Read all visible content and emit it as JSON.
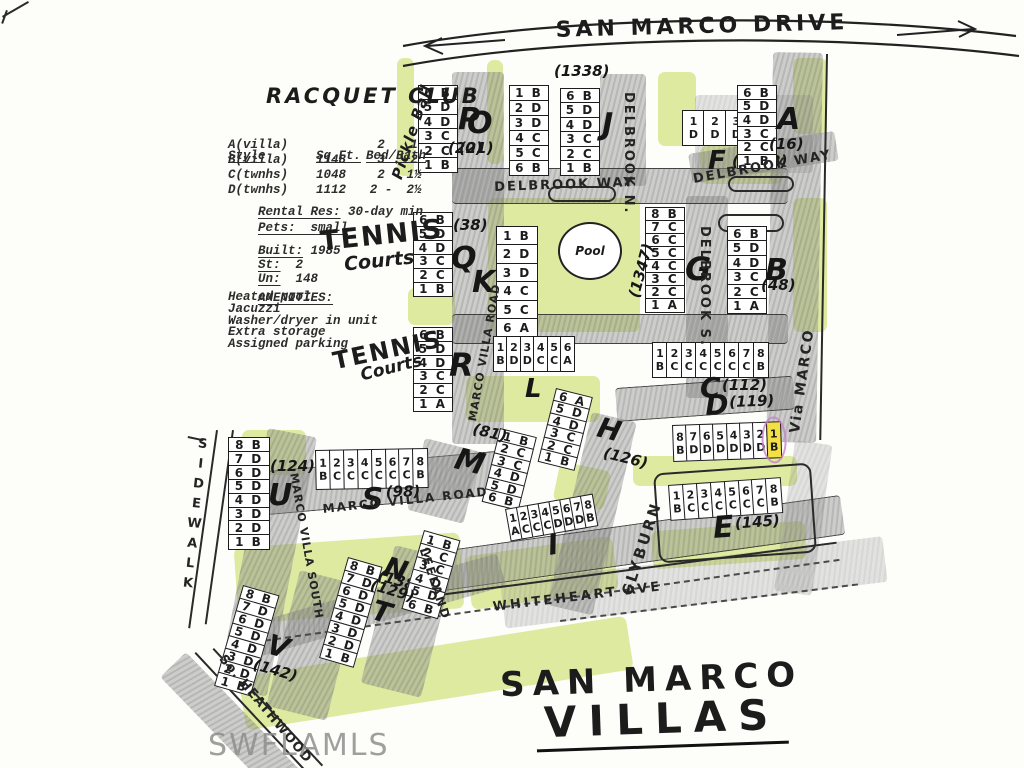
{
  "page": {
    "top_street": "SAN MARCO DRIVE",
    "bottom_title_line1": "SAN MARCO",
    "bottom_title_line2": "VILLAS",
    "watermark": "SWFLAMLS"
  },
  "legend": {
    "club_title": "RACQUET CLUB",
    "pickleball": "Pickle Ball",
    "table": {
      "col_style": "Style",
      "col_sqft": "Sq.Ft.",
      "col_bedbath": "Bed/Bath",
      "rows": [
        {
          "style": "A(villa)",
          "sqft": "",
          "bed": "2",
          "bath": "1"
        },
        {
          "style": "B(villa)",
          "sqft": "1148",
          "bed": "3",
          "bath": "2"
        },
        {
          "style": "C(twnhs)",
          "sqft": "1048",
          "bed": "2",
          "bath": "1½"
        },
        {
          "style": "D(twnhs)",
          "sqft": "1112",
          "bed": "2 -",
          "bath": "2½"
        }
      ]
    },
    "rental_label": "Rental Res:",
    "rental_value": " 30-day min",
    "pets_label": "Pets:",
    "pets_value": "  small",
    "built_label": "Built:",
    "built_value": " 1985",
    "st_label": "St:",
    "st_value": "  2",
    "un_label": "Un:",
    "un_value": "  148",
    "amenities_title": "AMENITIES:",
    "amenities": [
      "Heated pool",
      "Jacuzzi",
      "Washer/dryer in unit",
      "Extra storage",
      "Assigned parking"
    ]
  },
  "labels": {
    "tennis_1a": "TENNIS",
    "tennis_1b": "Courts",
    "tennis_2a": "TENNIS",
    "tennis_2b": "Courts",
    "pool": "Pool"
  },
  "streets": [
    {
      "id": "delbrook-way-w",
      "name": "DELBROOK  WAY"
    },
    {
      "id": "delbrook-way-e",
      "name": "DELBROOK  WAY"
    },
    {
      "id": "delbrook-n",
      "name": "DELBROOK  N."
    },
    {
      "id": "delbrook-s",
      "name": "DELBROOK  S."
    },
    {
      "id": "via-marco",
      "name": "Via  MARCO"
    },
    {
      "id": "marco-villa-road-n",
      "name": "MARCO  VILLA  ROAD"
    },
    {
      "id": "marco-villa-road-s",
      "name": "MARCO   VILLA   ROAD"
    },
    {
      "id": "marco-villa-south",
      "name": "MARCO  VILLA  SOUTH"
    },
    {
      "id": "clyburn",
      "name": "CLYBURN"
    },
    {
      "id": "leeland",
      "name": "LEELAND"
    },
    {
      "id": "whiteheart",
      "name": "WHITEHEART   AVE"
    },
    {
      "id": "so-heathwood",
      "name": "So. HEATHWOOD"
    },
    {
      "id": "sidewalk",
      "name": "SIDEWALK"
    }
  ],
  "buildings": [
    {
      "id": "P",
      "label": "P",
      "number": "(20)",
      "units": [
        "6B",
        "5D",
        "4D",
        "3C",
        "2C",
        "1B"
      ]
    },
    {
      "id": "O",
      "label": "O",
      "number": "(21)",
      "units": [
        "1B",
        "2D",
        "3D",
        "4C",
        "5C",
        "6B"
      ]
    },
    {
      "id": "J",
      "label": "J",
      "number": "(1338)",
      "units": [
        "6B",
        "5D",
        "4D",
        "3C",
        "2C",
        "1B"
      ]
    },
    {
      "id": "F",
      "label": "F",
      "number": "(1352)",
      "units": [
        "1D",
        "2D",
        "3D",
        "4A"
      ]
    },
    {
      "id": "A",
      "label": "A",
      "number": "(16)",
      "units": [
        "6B",
        "5D",
        "4D",
        "3C",
        "2C",
        "1B"
      ]
    },
    {
      "id": "Q",
      "label": "Q",
      "number": "(38)",
      "units": [
        "6B",
        "5D",
        "4D",
        "3C",
        "2C",
        "1B"
      ]
    },
    {
      "id": "K",
      "label": "K",
      "number": "",
      "units": [
        "1B",
        "2D",
        "3D",
        "4C",
        "5C",
        "6A"
      ]
    },
    {
      "id": "G",
      "label": "G",
      "number": "(1347)",
      "units": [
        "8B",
        "7C",
        "6C",
        "5C",
        "4C",
        "3C",
        "2C",
        "1A"
      ]
    },
    {
      "id": "B",
      "label": "B",
      "number": "(48)",
      "units": [
        "6B",
        "5D",
        "4D",
        "3C",
        "2C",
        "1A"
      ]
    },
    {
      "id": "R",
      "label": "R",
      "number": "",
      "units": [
        "6B",
        "5D",
        "4D",
        "3C",
        "2C",
        "1A"
      ]
    },
    {
      "id": "L",
      "label": "L",
      "number": "",
      "units": [
        "1B",
        "2D",
        "3D",
        "4C",
        "5C",
        "6A"
      ]
    },
    {
      "id": "C",
      "label": "C",
      "number": "(112)",
      "units": [
        "1B",
        "2C",
        "3C",
        "4C",
        "5C",
        "6C",
        "7C",
        "8B"
      ]
    },
    {
      "id": "D",
      "label": "D",
      "number": "(119)",
      "units": [
        "8B",
        "7D",
        "6D",
        "5D",
        "4D",
        "3D",
        "2D",
        "1B"
      ],
      "highlight_unit": "1B"
    },
    {
      "id": "H",
      "label": "H",
      "number": "(126)",
      "units": [
        "6A",
        "5D",
        "4D",
        "3C",
        "2C",
        "1B"
      ]
    },
    {
      "id": "M",
      "label": "M",
      "number": "(81)",
      "units": [
        "1B",
        "2C",
        "3C",
        "4D",
        "5D",
        "6B"
      ]
    },
    {
      "id": "E",
      "label": "E",
      "number": "(145)",
      "units": [
        "1B",
        "2C",
        "3C",
        "4C",
        "5C",
        "6C",
        "7C",
        "8B"
      ]
    },
    {
      "id": "I",
      "label": "I",
      "number": "",
      "units": [
        "1A",
        "2C",
        "3C",
        "4C",
        "5D",
        "6D",
        "7D",
        "8B"
      ]
    },
    {
      "id": "S",
      "label": "S",
      "number": "(98)",
      "units": [
        "1B",
        "2C",
        "3C",
        "4C",
        "5C",
        "6C",
        "7C",
        "8B"
      ]
    },
    {
      "id": "U",
      "label": "U",
      "number": "(124)",
      "units": [
        "8B",
        "7D",
        "6D",
        "5D",
        "4D",
        "3D",
        "2D",
        "1B"
      ]
    },
    {
      "id": "V",
      "label": "V",
      "number": "(142)",
      "units": [
        "8B",
        "7D",
        "6D",
        "5D",
        "4D",
        "3D",
        "2D",
        "1B"
      ]
    },
    {
      "id": "T",
      "label": "T",
      "number": "(138)",
      "units": [
        "8B",
        "7D",
        "6D",
        "5D",
        "4D",
        "3D",
        "2D",
        "1B"
      ]
    },
    {
      "id": "N",
      "label": "N",
      "number": "(129)",
      "units": [
        "1B",
        "2C",
        "3C",
        "4D",
        "5D",
        "6B"
      ]
    }
  ],
  "colors": {
    "ink": "#1c1c1c",
    "pencil_gray": "#8a8a8a",
    "highlighter_green": "#d6e58c",
    "highlight_yellow": "#f3e046",
    "highlight_ring": "#c97fd0",
    "watermark_gray": "#8f8f8f",
    "paper": "#fdfdfa"
  }
}
